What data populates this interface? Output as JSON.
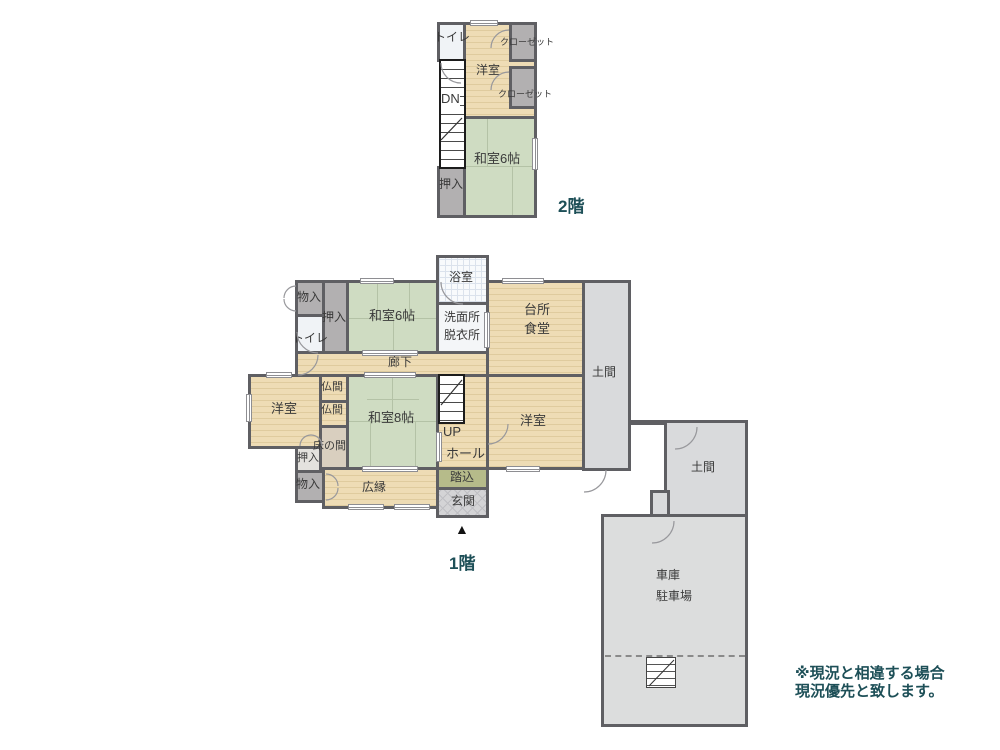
{
  "page": {
    "floor1_label": "1階",
    "floor2_label": "2階",
    "entrance_marker": "▲"
  },
  "disclaimer": {
    "line1": "※現況と相違する場合",
    "line2": "現況優先と致します。"
  },
  "floor2": {
    "toilet": "トイレ",
    "western_room": "洋室",
    "closet_top": "クローゼット",
    "closet_bottom": "クローゼット",
    "stairs_down": "DN",
    "tatami6": "和室6帖",
    "oshiire": "押入"
  },
  "floor1": {
    "storage_top": "物入",
    "closet_top": "押入",
    "toilet": "トイレ",
    "tatami6": "和室6帖",
    "bathroom": "浴室",
    "washroom_line1": "洗面所",
    "washroom_line2": "脱衣所",
    "kitchen_line1": "台所",
    "kitchen_line2": "食堂",
    "corridor": "廊下",
    "doma": "土間",
    "western_left": "洋室",
    "altar1": "仏間",
    "altar2": "仏間",
    "tatami8": "和室8帖",
    "stairs_up": "UP",
    "hall": "ホール",
    "western_right": "洋室",
    "tokonoma": "床の間",
    "closet_left": "押入",
    "storage_bottom": "物入",
    "veranda": "広縁",
    "fumikomi": "踏込",
    "entrance": "玄関"
  },
  "garage": {
    "doma": "土間",
    "label_line1": "車庫",
    "label_line2": "駐車場"
  },
  "colors": {
    "wall": "#5f5f63",
    "tatami": "#cfdcc2",
    "wood_floor": "#eedcb5",
    "closet": "#b2b0b1",
    "doma_gray": "#d9dadc",
    "fumikomi_green": "#b6bb8a",
    "accent_text": "#1d4f57"
  }
}
